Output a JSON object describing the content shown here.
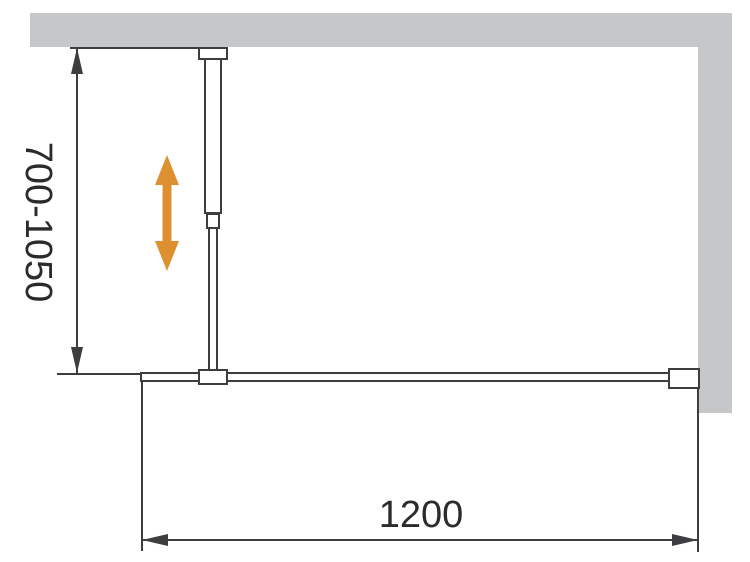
{
  "drawing": {
    "dimensions": {
      "height_range": {
        "label": "700-1050",
        "orientation": "vertical",
        "unit": "mm"
      },
      "width": {
        "label": "1200",
        "orientation": "horizontal",
        "unit": "mm"
      }
    },
    "icons": {
      "adjust_arrow": "double-headed-vertical-arrow"
    },
    "colors": {
      "background": "#FFFFFF",
      "wall_fill": "#C6C7C8",
      "line": "#3E3E40",
      "text": "#2B2B2B",
      "accent_orange": "#DE9030"
    }
  }
}
